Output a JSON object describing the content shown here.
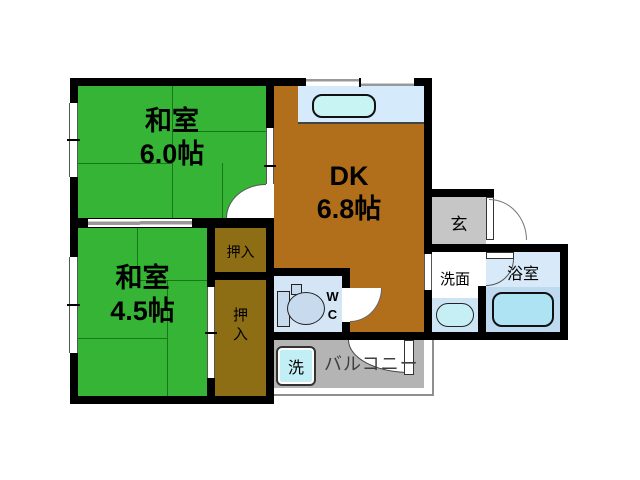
{
  "plan": {
    "rooms": {
      "washitsu1": {
        "name": "和室",
        "size": "6.0帖"
      },
      "washitsu2": {
        "name": "和室",
        "size": "4.5帖"
      },
      "dk": {
        "name": "DK",
        "size": "6.8帖"
      },
      "genkan": {
        "label": "玄"
      },
      "senmen": {
        "label": "洗面"
      },
      "bathroom": {
        "label": "浴室"
      },
      "wc": {
        "label": "WC"
      },
      "balcony": {
        "label": "バルコニー"
      },
      "washer": {
        "label": "洗"
      },
      "oshiire_upper": {
        "label": "押入"
      },
      "oshiire_lower": {
        "label": "押入"
      }
    },
    "colors": {
      "wall": "#000000",
      "tatami_green": "#35b435",
      "dk_brown": "#b26f1b",
      "closet_brown": "#8d6e15",
      "counter_blue": "#d5eafb",
      "sink_cyan": "#c9f4f4",
      "wc_blue": "#d4e6f5",
      "bath_blue": "#d8eaf9",
      "tub_blue": "#aee3f4",
      "genkan_gray": "#c6c6c6",
      "balcony_gray": "#b4b4b4"
    }
  }
}
